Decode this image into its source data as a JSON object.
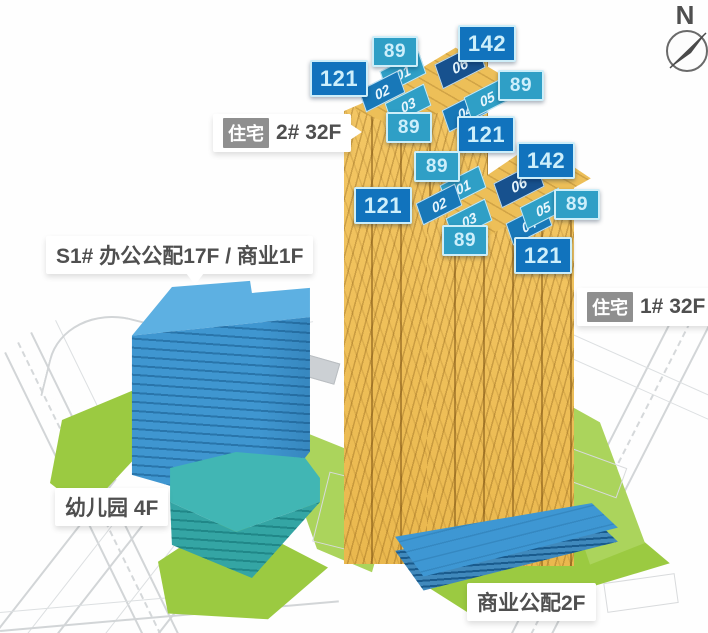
{
  "compass": {
    "north_label": "N"
  },
  "labels": {
    "tower2": {
      "tag": "住宅",
      "text": "2# 32F"
    },
    "tower1": {
      "tag": "住宅",
      "text": "1# 32F"
    },
    "office": {
      "text": "S1# 办公公配17F / 商业1F"
    },
    "kindergarten": {
      "text": "幼儿园 4F"
    },
    "podium": {
      "text": "商业公配2F"
    }
  },
  "areas": {
    "t2": {
      "left": "121",
      "top": "89",
      "top_right": "142",
      "right": "89",
      "bottom": "89",
      "bottom_right": "121"
    },
    "t1": {
      "left": "121",
      "top": "89",
      "top_right": "142",
      "right": "89",
      "bottom": "89",
      "bottom_right": "121"
    }
  },
  "units": {
    "t2": {
      "u1": "01",
      "u2": "02",
      "u3": "03",
      "u4": "04",
      "u5": "05",
      "u6": "06"
    },
    "t1": {
      "u1": "01",
      "u2": "02",
      "u3": "03",
      "u4": "04",
      "u5": "05",
      "u6": "06"
    }
  },
  "colors": {
    "badge_dark": "#1173bd",
    "badge_light": "#2f9fc6",
    "badge_navy": "#17518e",
    "tower_gold": "#f1c25e",
    "office_blue": "#3f96d0",
    "kindergarten_teal": "#34a5a4",
    "podium_blue": "#3e97d3",
    "green": "#9bca41",
    "label_tag_gray": "#8f8f8f"
  }
}
